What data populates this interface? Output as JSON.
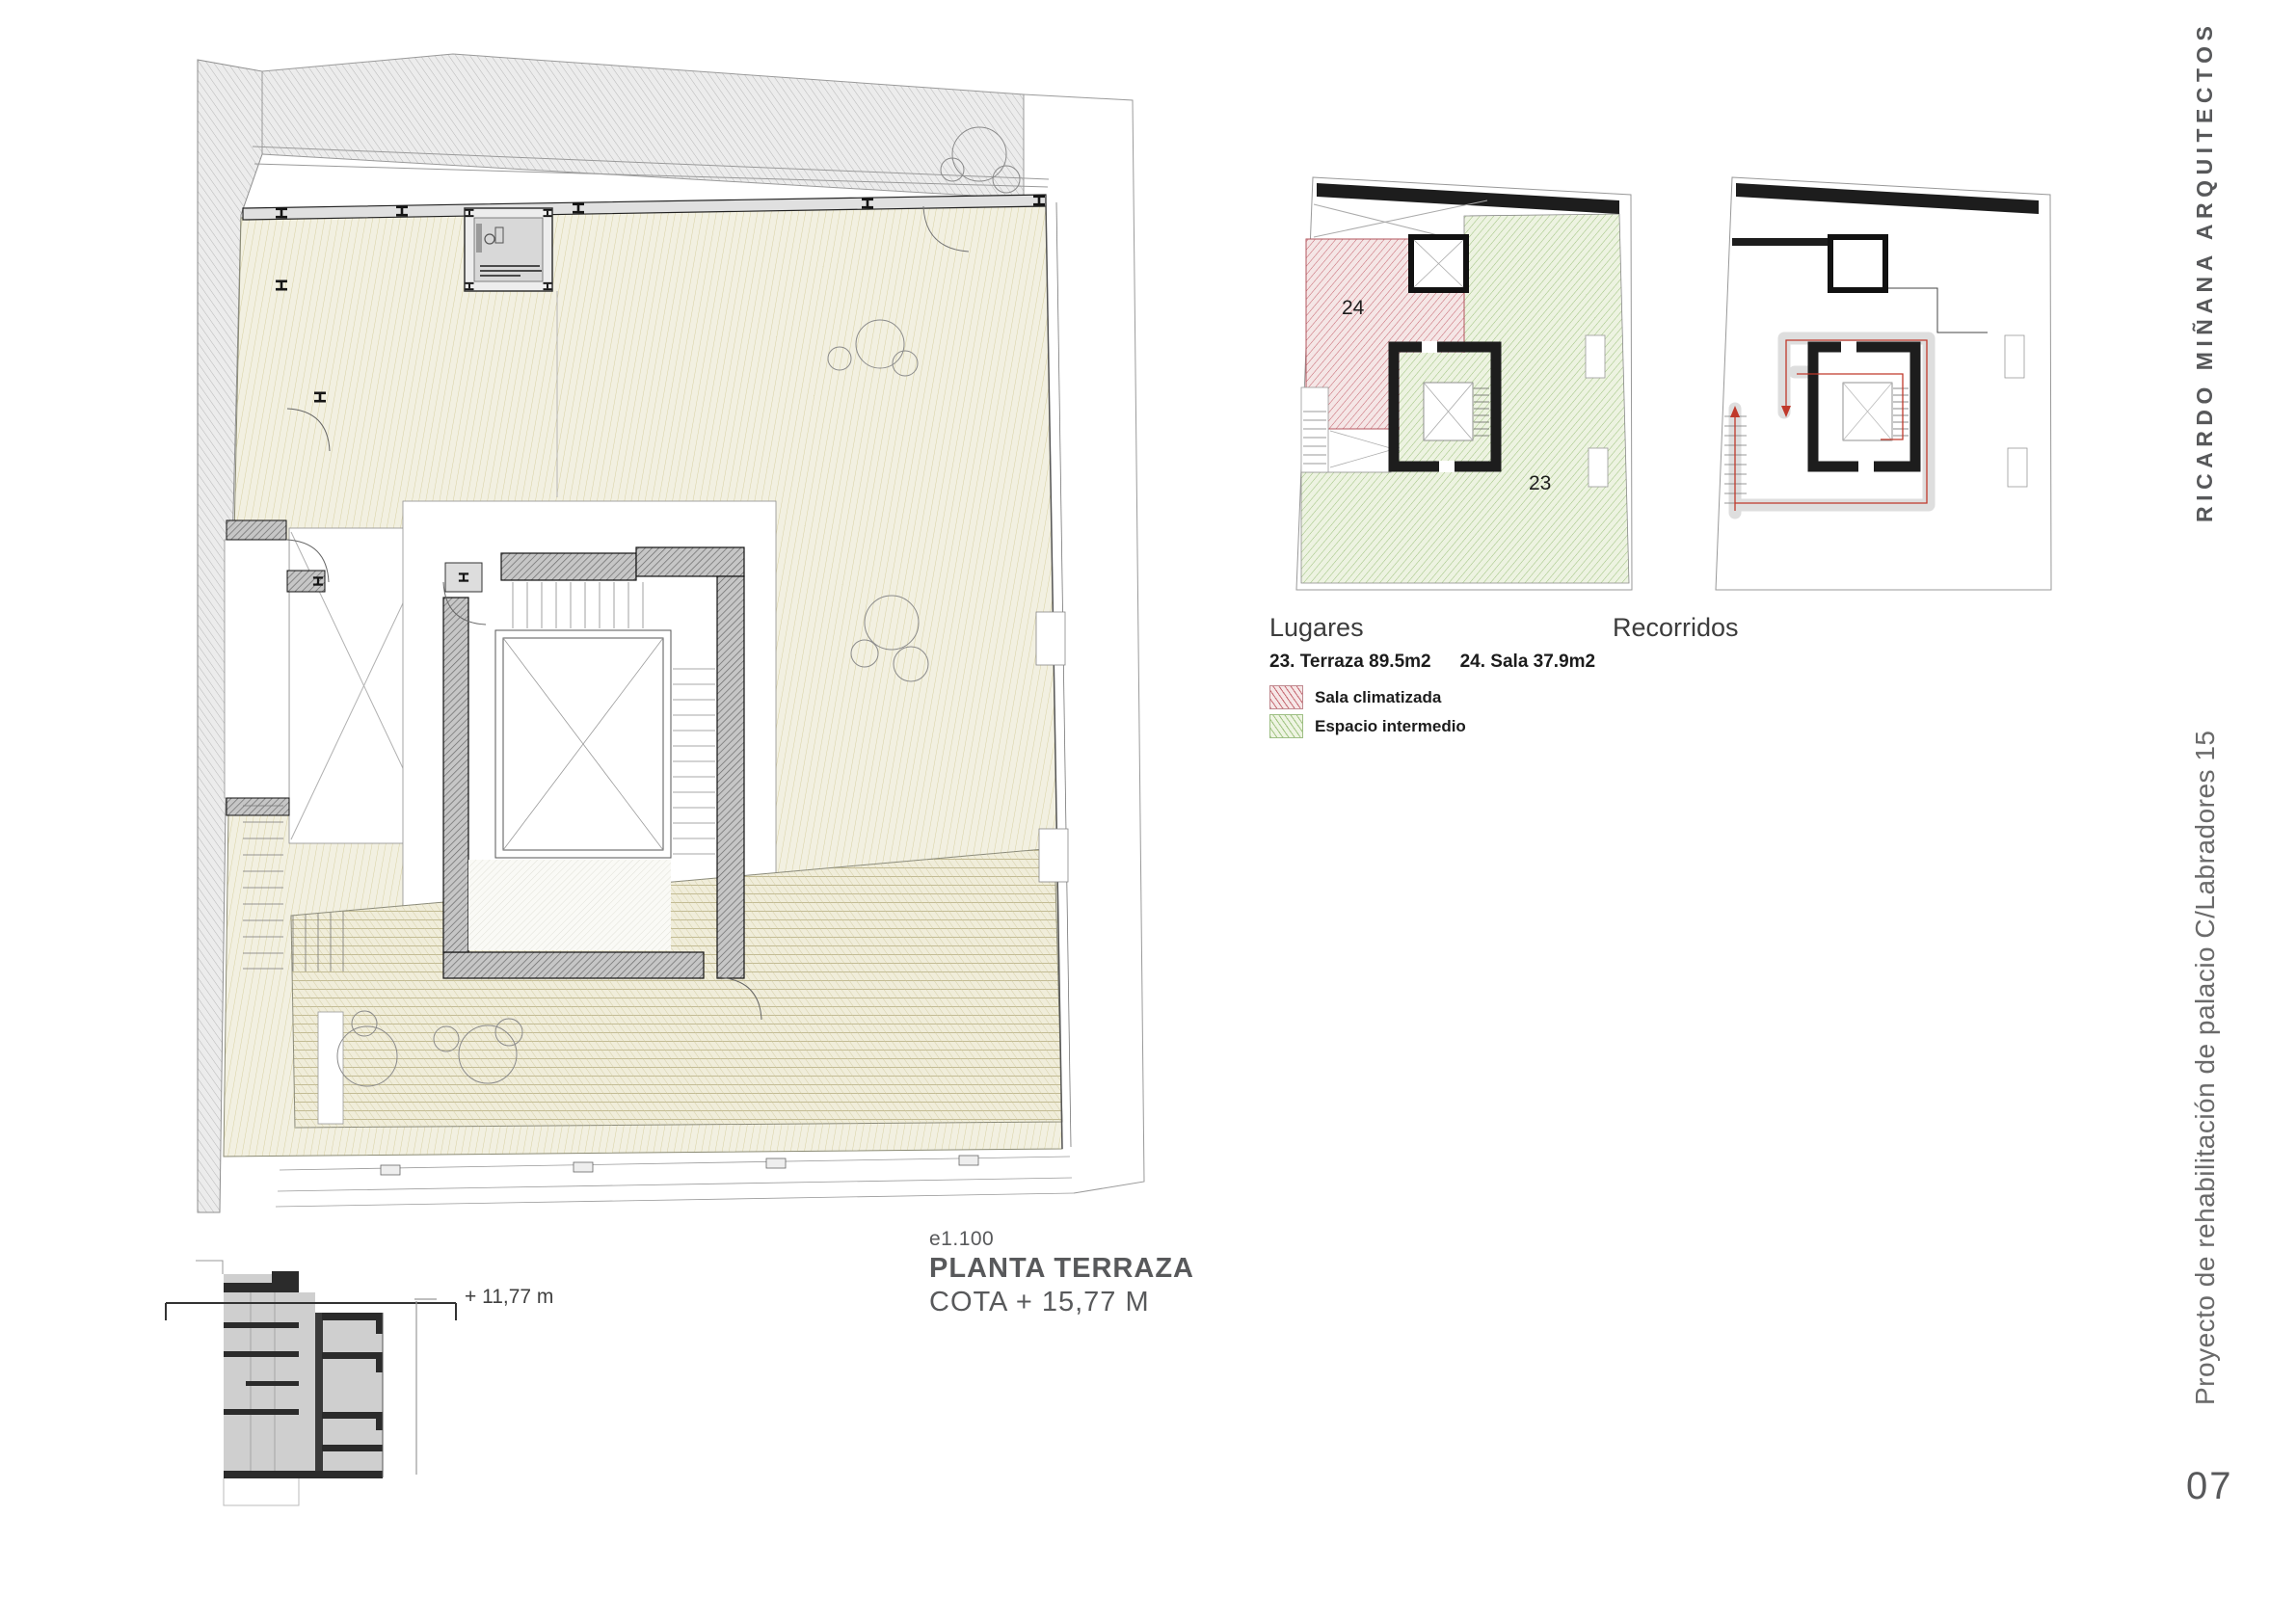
{
  "sheet": {
    "number": "07",
    "studio": "RICARDO MIÑANA ARQUITECTOS",
    "project": "Proyecto de rehabilitación de palacio C/Labradores 15"
  },
  "title_block": {
    "scale": "e1.100",
    "plan_title": "PLANTA TERRAZA",
    "level": "COTA + 15,77 M"
  },
  "section": {
    "level_mark": "+ 11,77 m"
  },
  "lugares": {
    "title": "Lugares",
    "area_terraza": "23. Terraza 89.5m2",
    "area_sala": "24. Sala 37.9m2",
    "room_terraza_number": "23",
    "room_sala_number": "24",
    "legend": [
      {
        "label": "Sala climatizada",
        "hatch_color": "#c4626c"
      },
      {
        "label": "Espacio intermedio",
        "hatch_color": "#9cc17c"
      }
    ]
  },
  "recorridos": {
    "title": "Recorridos"
  },
  "colors": {
    "terrace_hatch": "#d8d1a2",
    "neighbor_hatch": "#b7b7b7",
    "wall_hatch": "#6b6b6b",
    "route_line": "#c0392b",
    "route_band": "#dedede",
    "text_grey": "#58595b"
  }
}
